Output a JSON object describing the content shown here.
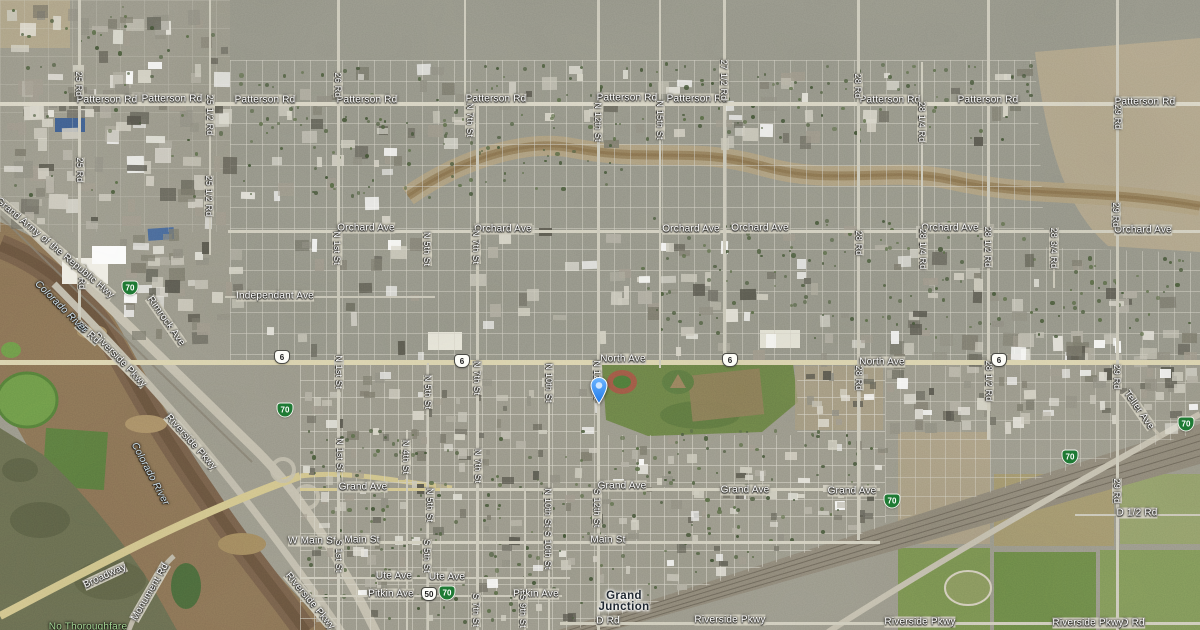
{
  "map": {
    "kind": "satellite-map",
    "city": "Grand Junction",
    "pin": {
      "x": 599,
      "y": 404,
      "color": "#2f7de0"
    },
    "colors": {
      "pin_blue": "#2f7de0",
      "road_label": "#ffffff",
      "city_label": "#1f2730",
      "water_label": "#cfe2ee",
      "nature_label": "#a5d695",
      "business_loop_green": "#1e7a34",
      "us_shield_white": "#fdfdf8"
    },
    "labels": {
      "horizontal": [
        {
          "t": "Patterson Rd",
          "x": 107,
          "y": 100
        },
        {
          "t": "Patterson Rd",
          "x": 172,
          "y": 99
        },
        {
          "t": "Patterson Rd",
          "x": 265,
          "y": 100
        },
        {
          "t": "Patterson Rd",
          "x": 367,
          "y": 100
        },
        {
          "t": "Patterson Rd",
          "x": 496,
          "y": 99
        },
        {
          "t": "Patterson Rd",
          "x": 627,
          "y": 98
        },
        {
          "t": "Patterson Rd",
          "x": 697,
          "y": 99
        },
        {
          "t": "Patterson Rd",
          "x": 890,
          "y": 100
        },
        {
          "t": "Patterson Rd",
          "x": 988,
          "y": 100
        },
        {
          "t": "Patterson Rd",
          "x": 1145,
          "y": 102
        },
        {
          "t": "Orchard Ave",
          "x": 366,
          "y": 228
        },
        {
          "t": "Orchard Ave",
          "x": 503,
          "y": 229
        },
        {
          "t": "Orchard Ave",
          "x": 691,
          "y": 229
        },
        {
          "t": "Orchard Ave",
          "x": 760,
          "y": 228
        },
        {
          "t": "Orchard Ave",
          "x": 950,
          "y": 228
        },
        {
          "t": "Orchard Ave",
          "x": 1143,
          "y": 230
        },
        {
          "t": "Independant Ave",
          "x": 275,
          "y": 296
        },
        {
          "t": "North Ave",
          "x": 623,
          "y": 359
        },
        {
          "t": "North Ave",
          "x": 882,
          "y": 362
        },
        {
          "t": "Grand Ave",
          "x": 363,
          "y": 487
        },
        {
          "t": "Grand Ave",
          "x": 622,
          "y": 486
        },
        {
          "t": "Grand Ave",
          "x": 745,
          "y": 490
        },
        {
          "t": "Grand Ave",
          "x": 852,
          "y": 491
        },
        {
          "t": "W Main St",
          "x": 312,
          "y": 541
        },
        {
          "t": "Main St",
          "x": 362,
          "y": 540
        },
        {
          "t": "Main St",
          "x": 608,
          "y": 540
        },
        {
          "t": "Ute Ave",
          "x": 394,
          "y": 576
        },
        {
          "t": "Ute Ave",
          "x": 447,
          "y": 577
        },
        {
          "t": "Pitkin Ave",
          "x": 391,
          "y": 594
        },
        {
          "t": "Pitkin Ave",
          "x": 536,
          "y": 594
        },
        {
          "t": "D Rd",
          "x": 608,
          "y": 621
        },
        {
          "t": "D Rd",
          "x": 1133,
          "y": 623
        },
        {
          "t": "D 1/2 Rd",
          "x": 1137,
          "y": 513
        },
        {
          "t": "Riverside Pkwy",
          "x": 730,
          "y": 620
        },
        {
          "t": "Riverside Pkwy",
          "x": 920,
          "y": 622
        },
        {
          "t": "Riverside Pkwy",
          "x": 1088,
          "y": 623
        }
      ],
      "vertical": [
        {
          "t": "25 Rd",
          "x": 79,
          "y": 84
        },
        {
          "t": "25 Rd",
          "x": 80,
          "y": 170
        },
        {
          "t": "25 Rd",
          "x": 82,
          "y": 277
        },
        {
          "t": "25 1/2 Rd",
          "x": 210,
          "y": 115
        },
        {
          "t": "25 1/2 Rd",
          "x": 209,
          "y": 196
        },
        {
          "t": "26 Rd",
          "x": 338,
          "y": 85
        },
        {
          "t": "27 1/2 Rd",
          "x": 724,
          "y": 80
        },
        {
          "t": "28 Rd",
          "x": 858,
          "y": 86
        },
        {
          "t": "28 Rd",
          "x": 859,
          "y": 243
        },
        {
          "t": "28 Rd",
          "x": 859,
          "y": 378
        },
        {
          "t": "28 1/4 Rd",
          "x": 922,
          "y": 122
        },
        {
          "t": "28 1/4 Rd",
          "x": 923,
          "y": 249
        },
        {
          "t": "28 1/2 Rd",
          "x": 988,
          "y": 247
        },
        {
          "t": "28 1/2 Rd",
          "x": 989,
          "y": 381
        },
        {
          "t": "28 3/4 Rd",
          "x": 1054,
          "y": 248
        },
        {
          "t": "29 Rd",
          "x": 1118,
          "y": 117
        },
        {
          "t": "29 Rd",
          "x": 1116,
          "y": 215
        },
        {
          "t": "29 Rd",
          "x": 1117,
          "y": 377
        },
        {
          "t": "29 Rd",
          "x": 1117,
          "y": 491
        },
        {
          "t": "N 12th St",
          "x": 598,
          "y": 122
        },
        {
          "t": "N 12th St",
          "x": 597,
          "y": 380
        },
        {
          "t": "N 15th St",
          "x": 660,
          "y": 120
        },
        {
          "t": "N 7th St",
          "x": 470,
          "y": 120
        },
        {
          "t": "N 7th St",
          "x": 476,
          "y": 247
        },
        {
          "t": "N 7th St",
          "x": 477,
          "y": 378
        },
        {
          "t": "N 7th St",
          "x": 478,
          "y": 466
        },
        {
          "t": "N 1st St",
          "x": 337,
          "y": 248
        },
        {
          "t": "N 1st St",
          "x": 339,
          "y": 372
        },
        {
          "t": "N 1st St",
          "x": 340,
          "y": 455
        },
        {
          "t": "N 4th St",
          "x": 406,
          "y": 457
        },
        {
          "t": "N 5th St",
          "x": 427,
          "y": 249
        },
        {
          "t": "N 5th St",
          "x": 428,
          "y": 392
        },
        {
          "t": "N 5th St",
          "x": 430,
          "y": 505
        },
        {
          "t": "N 10th St",
          "x": 549,
          "y": 383
        },
        {
          "t": "N 10th St",
          "x": 548,
          "y": 508
        },
        {
          "t": "S 12th St",
          "x": 597,
          "y": 508
        },
        {
          "t": "S 1st St",
          "x": 339,
          "y": 556
        },
        {
          "t": "S 5th St",
          "x": 427,
          "y": 556
        },
        {
          "t": "S 10th St",
          "x": 548,
          "y": 550
        },
        {
          "t": "S 7th St",
          "x": 476,
          "y": 610
        },
        {
          "t": "S 9th St",
          "x": 523,
          "y": 611
        }
      ],
      "diagonal": [
        {
          "t": "Riverside Pkwy",
          "x": 120,
          "y": 360,
          "r": 46
        },
        {
          "t": "Riverside Pkwy",
          "x": 191,
          "y": 442,
          "r": 48
        },
        {
          "t": "Riverside Pkwy",
          "x": 310,
          "y": 601,
          "r": 50
        },
        {
          "t": "Broadway",
          "x": 105,
          "y": 576,
          "r": -25
        },
        {
          "t": "Monument Rd",
          "x": 150,
          "y": 592,
          "r": -60
        },
        {
          "t": "Grand Army of the Republic Hwy",
          "x": 55,
          "y": 248,
          "r": 40
        },
        {
          "t": "Rimrock Ave",
          "x": 166,
          "y": 321,
          "r": 55
        },
        {
          "t": "Teller Ave",
          "x": 1139,
          "y": 410,
          "r": 55
        },
        {
          "t": "25 Rd",
          "x": 88,
          "y": 333,
          "r": 42
        }
      ],
      "water": [
        {
          "t": "Colorado River",
          "x": 61,
          "y": 307,
          "r": 45
        },
        {
          "t": "Colorado River",
          "x": 150,
          "y": 474,
          "r": 62
        }
      ],
      "nature": [
        {
          "t": "No Thoroughfare",
          "x": 88,
          "y": 627,
          "r": 0
        }
      ],
      "city_label": {
        "line1": "Grand",
        "line2": "Junction",
        "x": 624,
        "y": 602
      }
    },
    "shields": [
      {
        "system": "us-route",
        "t": "6",
        "x": 282,
        "y": 357
      },
      {
        "system": "us-route",
        "t": "6",
        "x": 462,
        "y": 361
      },
      {
        "system": "us-route",
        "t": "6",
        "x": 730,
        "y": 360
      },
      {
        "system": "us-route",
        "t": "6",
        "x": 999,
        "y": 360
      },
      {
        "system": "us-route",
        "t": "50",
        "x": 429,
        "y": 594
      },
      {
        "system": "interstate-business",
        "t": "70",
        "x": 130,
        "y": 288
      },
      {
        "system": "interstate-business",
        "t": "70",
        "x": 285,
        "y": 410
      },
      {
        "system": "interstate-business",
        "t": "70",
        "x": 892,
        "y": 501
      },
      {
        "system": "interstate-business",
        "t": "70",
        "x": 447,
        "y": 593
      },
      {
        "system": "interstate-business",
        "t": "70",
        "x": 1070,
        "y": 457
      },
      {
        "system": "interstate-business",
        "t": "70",
        "x": 1186,
        "y": 424
      }
    ]
  }
}
